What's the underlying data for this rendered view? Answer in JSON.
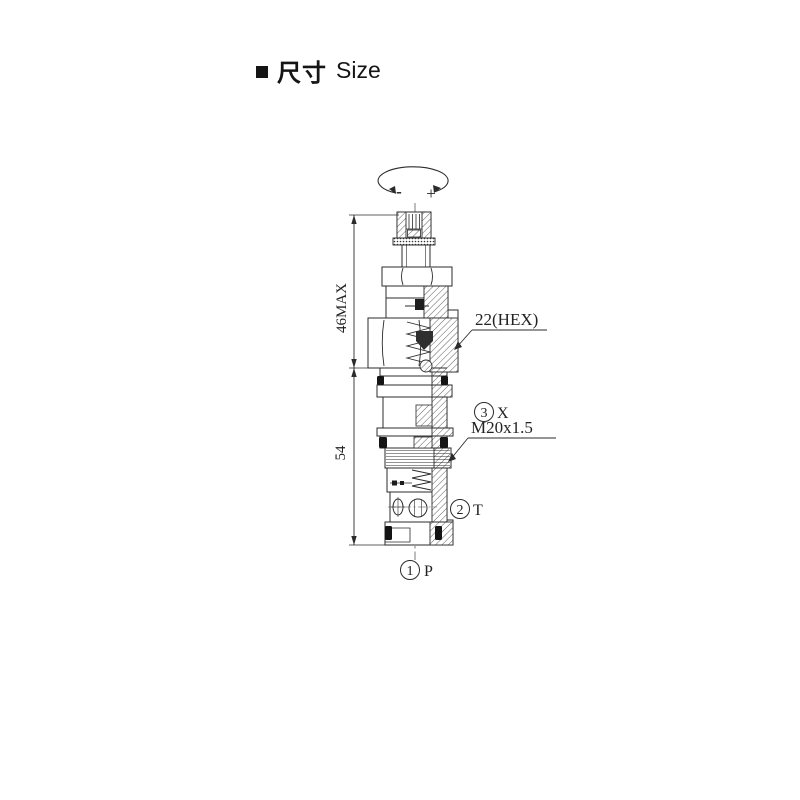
{
  "header": {
    "bullet_icon": "black-square",
    "title_zh": "尺寸",
    "title_en": "Size"
  },
  "rotation_symbol": {
    "minus_label": "-",
    "plus_label": "+"
  },
  "dimensions": {
    "height_upper": "46MAX",
    "height_lower": "54"
  },
  "callouts": {
    "hex_size": "22(HEX)",
    "thread_spec": "M20x1.5"
  },
  "ports": {
    "x": {
      "number": "3",
      "letter": "X"
    },
    "t": {
      "number": "2",
      "letter": "T"
    },
    "p": {
      "number": "1",
      "letter": "P"
    }
  },
  "colors": {
    "line": "#2b2b2b",
    "text": "#222222",
    "background": "#ffffff"
  }
}
